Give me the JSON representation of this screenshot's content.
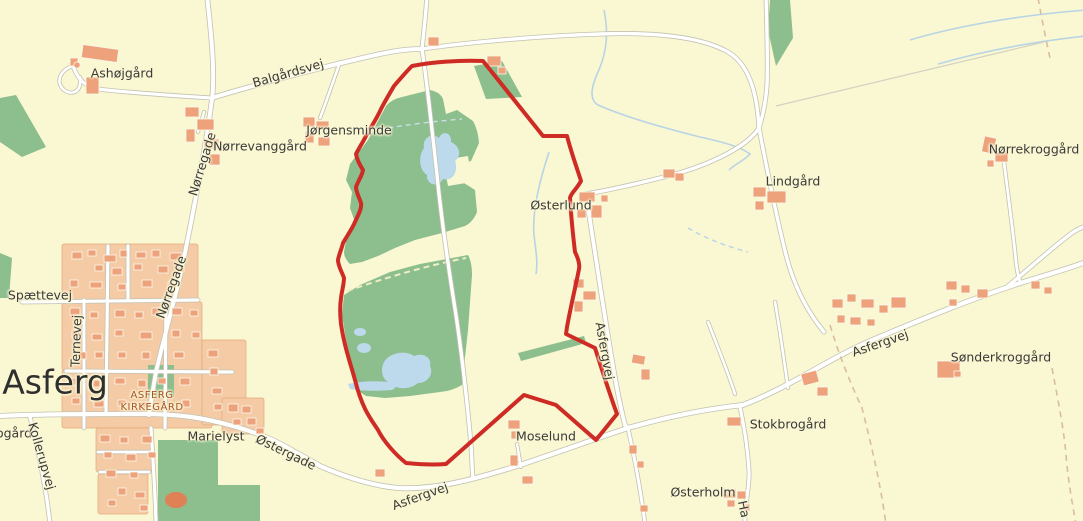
{
  "map": {
    "town_name": "Asferg",
    "colors": {
      "background": "#FAF7D3",
      "vegetation_green": "#8CBE8E",
      "water_blue": "#BCDAEB",
      "building_orange": "#EDA27C",
      "urban_block": "#F5CBA6",
      "road_fill": "#FFFFFF",
      "road_casing": "#C2C2B2",
      "boundary_red": "#CE2B25",
      "label_dark": "#3A3A3A",
      "cemetery_label_color": "#A8512B",
      "sports_track_orange": "#DF8155"
    },
    "labels": [
      {
        "id": "ashojgaard",
        "text": "Ashøjgård",
        "x": 122,
        "y": 73,
        "rot": 0
      },
      {
        "id": "balgaardsvej",
        "text": "Balgårdsvej",
        "x": 288,
        "y": 73,
        "rot": -16
      },
      {
        "id": "norregade-north",
        "text": "Nørregade",
        "x": 202,
        "y": 164,
        "rot": -73
      },
      {
        "id": "norrevanggaard",
        "text": "Nørrevanggård",
        "x": 260,
        "y": 146,
        "rot": 0
      },
      {
        "id": "jorgensminde",
        "text": "Jørgensminde",
        "x": 349,
        "y": 130,
        "rot": 0
      },
      {
        "id": "osterlund",
        "text": "Østerlund",
        "x": 561,
        "y": 205,
        "rot": 0
      },
      {
        "id": "lindgaard",
        "text": "Lindgård",
        "x": 793,
        "y": 181,
        "rot": 0
      },
      {
        "id": "norrekroggaard",
        "text": "Nørrekroggård",
        "x": 1034,
        "y": 149,
        "rot": 0
      },
      {
        "id": "spaettevej",
        "text": "Spættevej",
        "x": 40,
        "y": 295,
        "rot": 0
      },
      {
        "id": "ternevej",
        "text": "Ternevej",
        "x": 76,
        "y": 341,
        "rot": -88
      },
      {
        "id": "norregade-south",
        "text": "Nørregade",
        "x": 171,
        "y": 287,
        "rot": -70
      },
      {
        "id": "asferg-town",
        "text": "Asferg",
        "x": 55,
        "y": 383,
        "rot": 0,
        "size": 33,
        "color": "#2F2F2F"
      },
      {
        "id": "kirkegaard-line1",
        "text": "ASFERG",
        "x": 152,
        "y": 396,
        "rot": 0,
        "size": 10,
        "color": "#A8512B",
        "ls": 0.5
      },
      {
        "id": "kirkegaard-line2",
        "text": "KIRKEGÅRD",
        "x": 152,
        "y": 408,
        "rot": 0,
        "size": 10,
        "color": "#A8512B",
        "ls": 0.5
      },
      {
        "id": "ogaard-partial",
        "text": "ogård",
        "x": 14,
        "y": 433,
        "rot": 0
      },
      {
        "id": "kollerupvej",
        "text": "Kollerupvej",
        "x": 42,
        "y": 456,
        "rot": 74
      },
      {
        "id": "marielyst",
        "text": "Marielyst",
        "x": 216,
        "y": 436,
        "rot": 0
      },
      {
        "id": "ostergade",
        "text": "Østergade",
        "x": 286,
        "y": 452,
        "rot": 26
      },
      {
        "id": "asfergvej-southwest",
        "text": "Asfergvej",
        "x": 420,
        "y": 496,
        "rot": -20
      },
      {
        "id": "asfergvej-middle",
        "text": "Asfergvej",
        "x": 605,
        "y": 351,
        "rot": 80
      },
      {
        "id": "moselund",
        "text": "Moselund",
        "x": 546,
        "y": 436,
        "rot": 0
      },
      {
        "id": "stokbrogaard",
        "text": "Stokbrogård",
        "x": 788,
        "y": 424,
        "rot": 0
      },
      {
        "id": "osterholm",
        "text": "Østerholm",
        "x": 703,
        "y": 492,
        "rot": 0
      },
      {
        "id": "sonderkroggaard",
        "text": "Sønderkroggård",
        "x": 1001,
        "y": 357,
        "rot": 0
      },
      {
        "id": "asfergvej-east",
        "text": "Asfergvej",
        "x": 880,
        "y": 343,
        "rot": -19
      },
      {
        "id": "ha-partial",
        "text": "Ha",
        "x": 744,
        "y": 509,
        "rot": 78
      }
    ]
  }
}
